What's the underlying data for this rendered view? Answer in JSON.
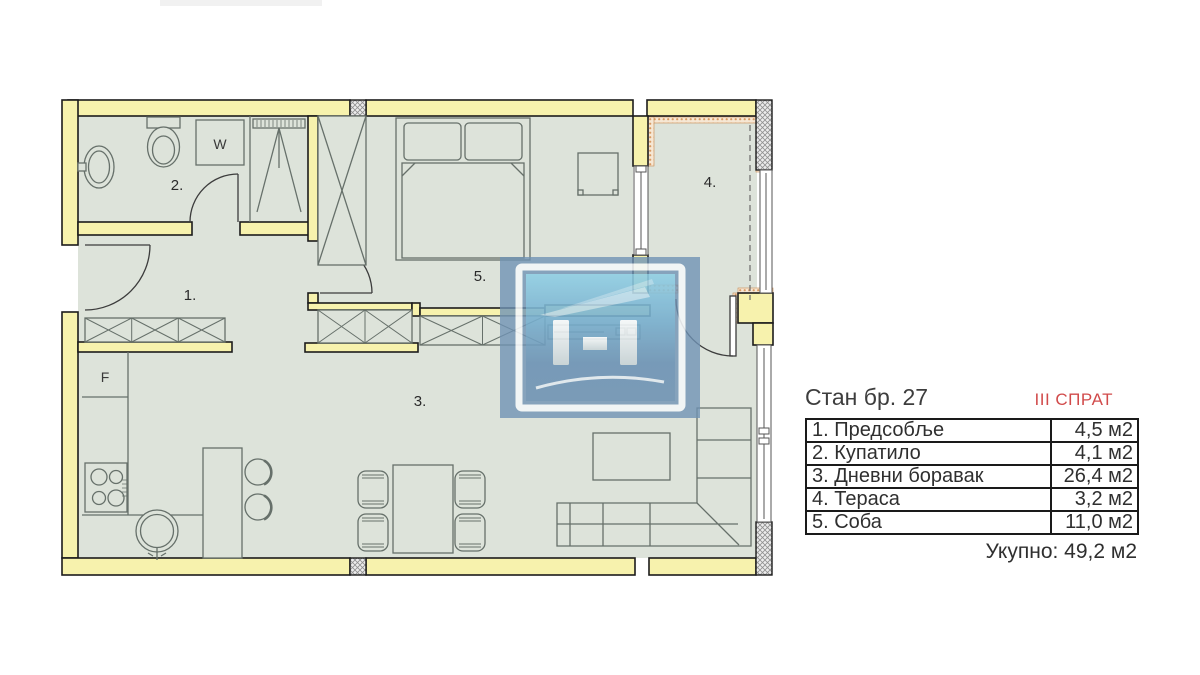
{
  "window": {
    "width": 1200,
    "height": 675,
    "background": "#ffffff"
  },
  "floor_plan": {
    "room_labels": [
      {
        "room": "hallway",
        "label": "1."
      },
      {
        "room": "bathroom",
        "label": "2."
      },
      {
        "room": "living-room",
        "label": "3."
      },
      {
        "room": "terrace",
        "label": "4."
      },
      {
        "room": "bedroom",
        "label": "5."
      }
    ],
    "fixture_labels": [
      {
        "fixture": "washing-machine",
        "label": "W"
      },
      {
        "fixture": "fridge",
        "label": "F"
      }
    ],
    "colors": {
      "wall_fill": "#f7f2ad",
      "floor_fill": "#dde3da",
      "outline": "#1c1c1c",
      "furniture_line": "#66706a",
      "insulation": "#d99a62",
      "column_hatch": "#909090"
    }
  },
  "watermark": {
    "shape": "h-monogram-logo",
    "primary_color": "#6e92b4",
    "light_color": "#8fd3ea"
  },
  "info_panel": {
    "title": "Стан бр. 27",
    "floor_label": "III СПРАТ",
    "floor_color": "#d14b4b",
    "rows": [
      {
        "name": "1. Предсобље",
        "area": "4,5 м2"
      },
      {
        "name": "2. Купатило",
        "area": "4,1 м2"
      },
      {
        "name": "3. Дневни боравак",
        "area": "26,4 м2"
      },
      {
        "name": "4. Тераса",
        "area": "3,2 м2"
      },
      {
        "name": "5. Соба",
        "area": "11,0 м2"
      }
    ],
    "total": "Укупно: 49,2 м2"
  }
}
